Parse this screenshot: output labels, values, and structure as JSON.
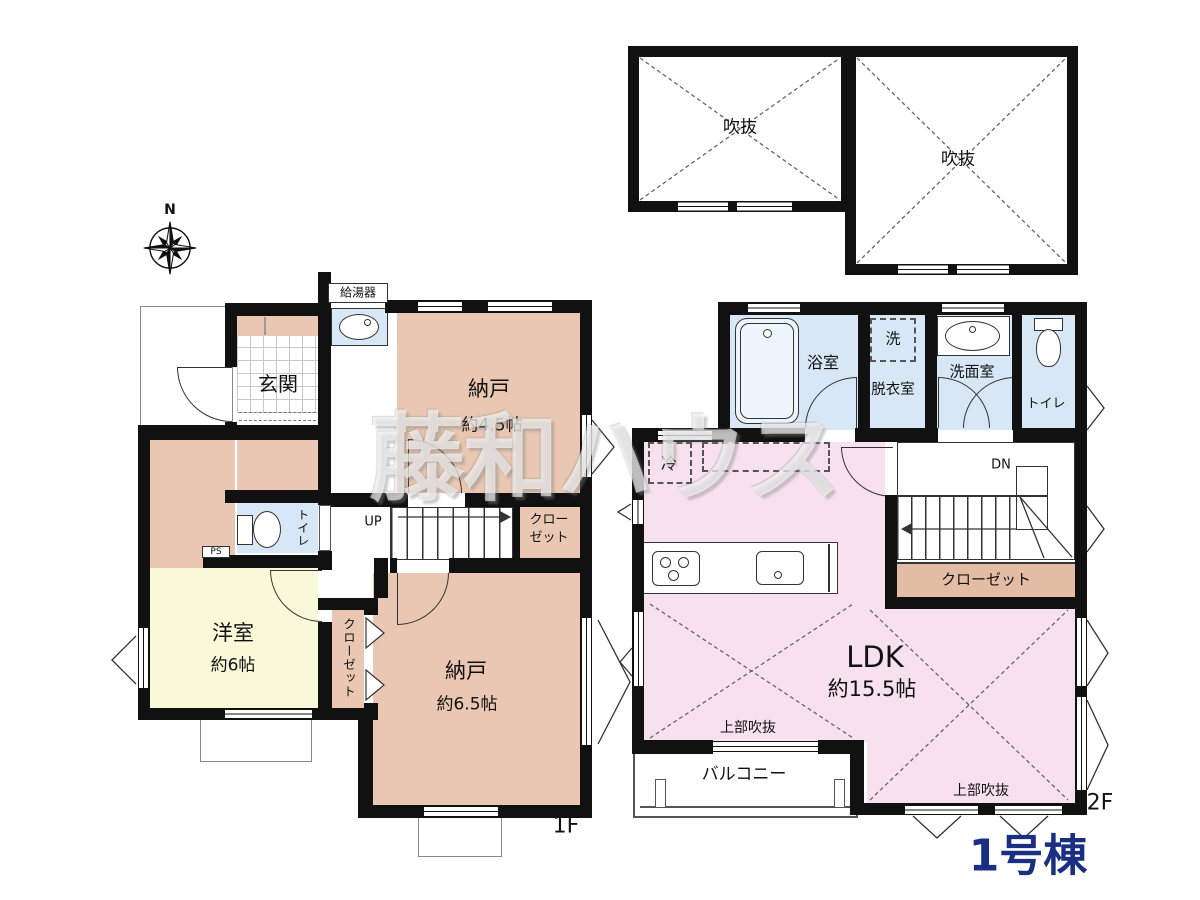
{
  "compass": {
    "north": "N"
  },
  "watermark": "藤和ハウス",
  "building_label": "1号棟",
  "attic": {
    "void_left": "吹抜",
    "void_right": "吹抜"
  },
  "floor1": {
    "label": "1F",
    "water_heater": "給湯器",
    "entrance": "玄関",
    "storage_a": {
      "name": "納戸",
      "size": "約4.5帖"
    },
    "stair_closet": {
      "line1": "クロー",
      "line2": "ゼット"
    },
    "toilet": "トイレ",
    "pipe_space": "PS",
    "stairs": "UP",
    "western_room": {
      "name": "洋室",
      "size": "約6帖"
    },
    "closet": "クローゼット",
    "storage_b": {
      "name": "納戸",
      "size": "約6.5帖"
    }
  },
  "floor2": {
    "label": "2F",
    "bathroom": "浴室",
    "washer": "洗",
    "dressing_room": "脱衣室",
    "washroom": "洗面室",
    "toilet": "トイレ",
    "fridge": "冷",
    "stairs": "DN",
    "closet": "クローゼット",
    "ldk": {
      "name": "LDK",
      "size": "約15.5帖"
    },
    "upper_void_left": "上部吹抜",
    "upper_void_right": "上部吹抜",
    "balcony": "バルコニー"
  },
  "colors": {
    "wall": "#111111",
    "storage_tan": "#e9c7b2",
    "western_yellow": "#f9f9da",
    "wet_blue": "#d8e7f6",
    "ldk_pink": "#f8e1ef",
    "closet2f_tan": "#e2bca3",
    "building_navy": "#1b2f82"
  }
}
